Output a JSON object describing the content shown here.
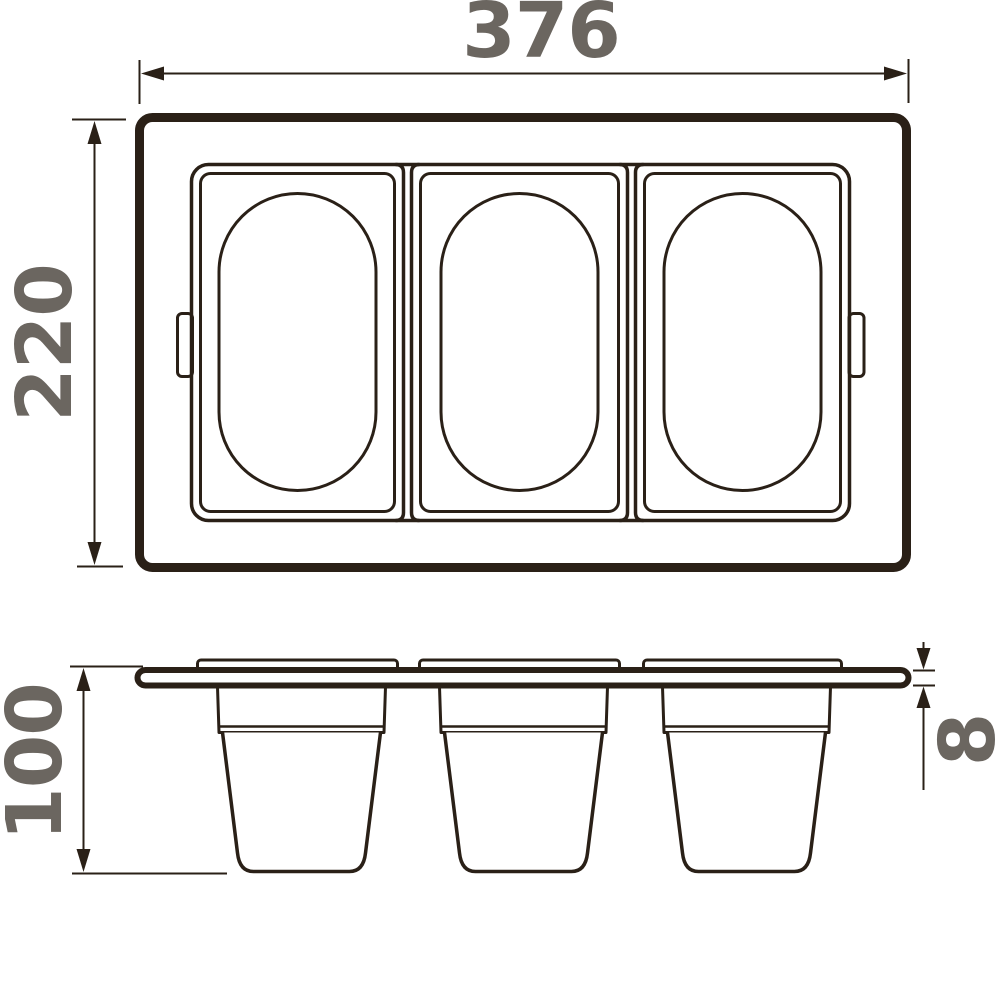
{
  "colors": {
    "line": "#2a2017",
    "dimension_text": "#6b6660",
    "background": "#ffffff"
  },
  "views": {
    "top_view": {
      "width_label": "376",
      "depth_label": "220"
    },
    "side_view": {
      "height_label": "100",
      "thickness_label": "8"
    }
  }
}
